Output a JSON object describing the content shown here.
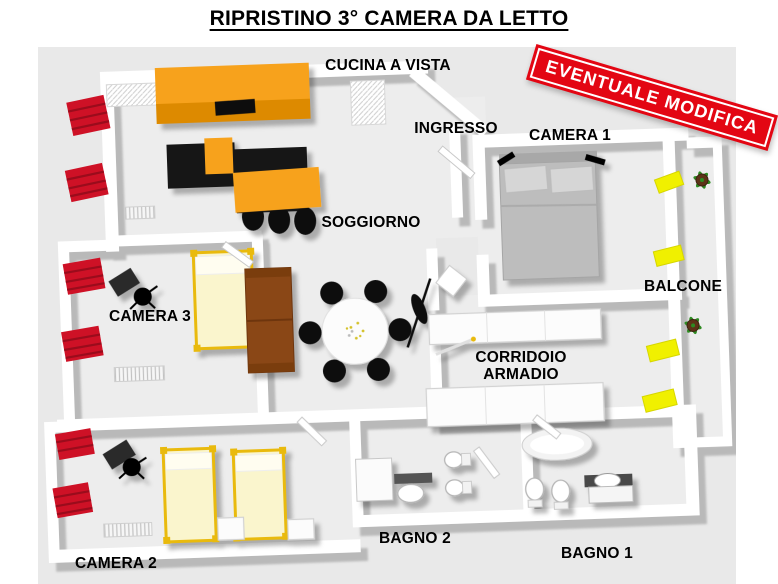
{
  "title": "RIPRISTINO 3° CAMERA DA LETTO",
  "banner": {
    "text": "EVENTUALE MODIFICA",
    "color": "#e30613"
  },
  "rooms": {
    "cucina": {
      "label": "CUCINA A VISTA"
    },
    "ingresso": {
      "label": "INGRESSO"
    },
    "camera1": {
      "label": "CAMERA 1"
    },
    "soggiorno": {
      "label": "SOGGIORNO"
    },
    "camera3": {
      "label": "CAMERA 3"
    },
    "balcone": {
      "label": "BALCONE"
    },
    "corridoio": {
      "label_line1": "CORRIDOIO",
      "label_line2": "ARMADIO"
    },
    "camera2": {
      "label": "CAMERA 2"
    },
    "bagno2": {
      "label": "BAGNO 2"
    },
    "bagno1": {
      "label": "BAGNO 1"
    }
  },
  "colors": {
    "banner_red": "#e30613",
    "curtain_red": "#ce1126",
    "kitchen_orange": "#f7a21e",
    "kitchen_orange_dark": "#dd8a05",
    "island_black": "#161616",
    "bed_pale_yellow": "#faf5cd",
    "frame_gold": "#e9ba10",
    "sofa_brown": "#8a4612",
    "bed_gray": "#bdbdbd",
    "balcony_window_yellow": "#f0f000",
    "plant_green": "#2e8b22",
    "wall_white": "#ffffff",
    "floor_gray": "#e9e9e9"
  }
}
